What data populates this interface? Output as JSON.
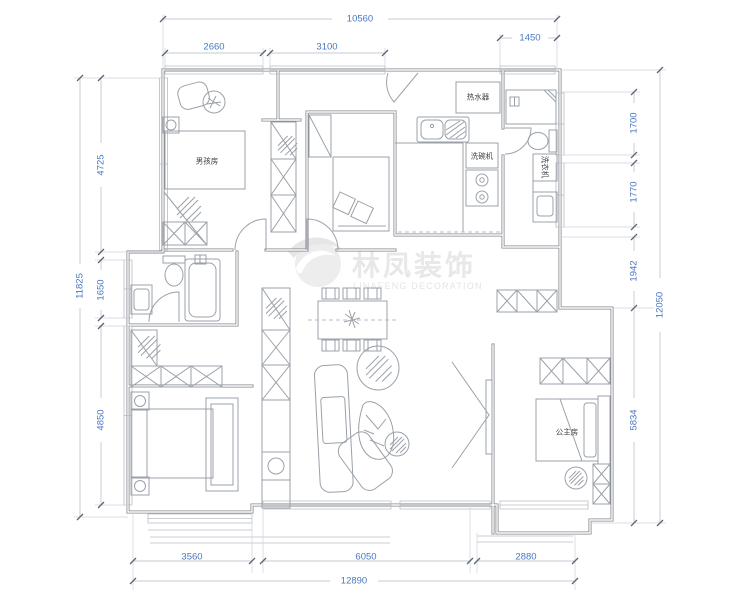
{
  "watermark": {
    "brand_cn": "林凤装饰",
    "brand_en": "LIN&FENG DECORATION"
  },
  "rooms": {
    "boys_room": "男孩房",
    "princess_room": "公主房"
  },
  "fixtures": {
    "water_heater": "热水器",
    "dishwasher": "洗碗机",
    "washing_machine": "洗衣机"
  },
  "dimensions": {
    "top": {
      "overall": "10560",
      "segments": [
        "2660",
        "3100",
        "1450"
      ]
    },
    "left": {
      "overall": "11825",
      "segments": [
        "4725",
        "1650",
        "4850"
      ]
    },
    "right": {
      "overall": "12050",
      "segments": [
        "1700",
        "1770",
        "1942",
        "5834"
      ]
    },
    "bottom": {
      "overall": "12890",
      "segments": [
        "3560",
        "6050",
        "2880"
      ]
    }
  },
  "colors": {
    "dimension_text": "#4878c0",
    "wall_line": "#80858c",
    "furniture_line": "#9ba1a9",
    "label_text": "#3c4045",
    "watermark": "#e8e8e8",
    "background": "#ffffff"
  }
}
